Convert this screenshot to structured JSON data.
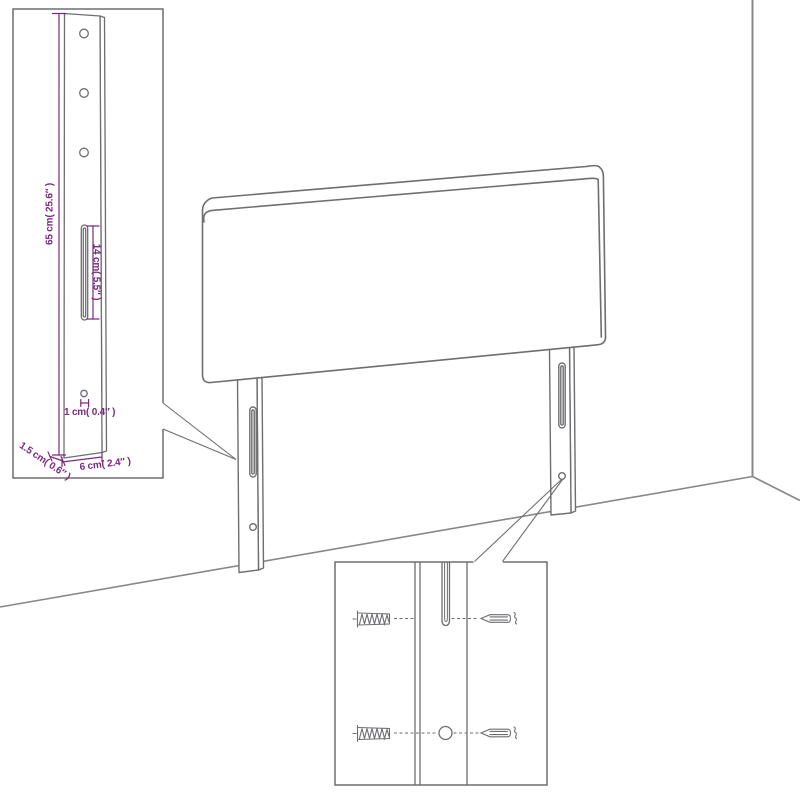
{
  "diagram": {
    "background": "#ffffff",
    "colors": {
      "line": "#6d6e71",
      "wall": "#85878a",
      "dimension": "#7a2a7f"
    },
    "labels": {
      "height": "65 cm( 25.6″ )",
      "slot_length": "14 cm( 5.5″ )",
      "hole": "1 cm( 0.4″ )",
      "thickness": "1.5 cm( 0.6″ )",
      "width": "6 cm( 2.4″ )"
    }
  }
}
